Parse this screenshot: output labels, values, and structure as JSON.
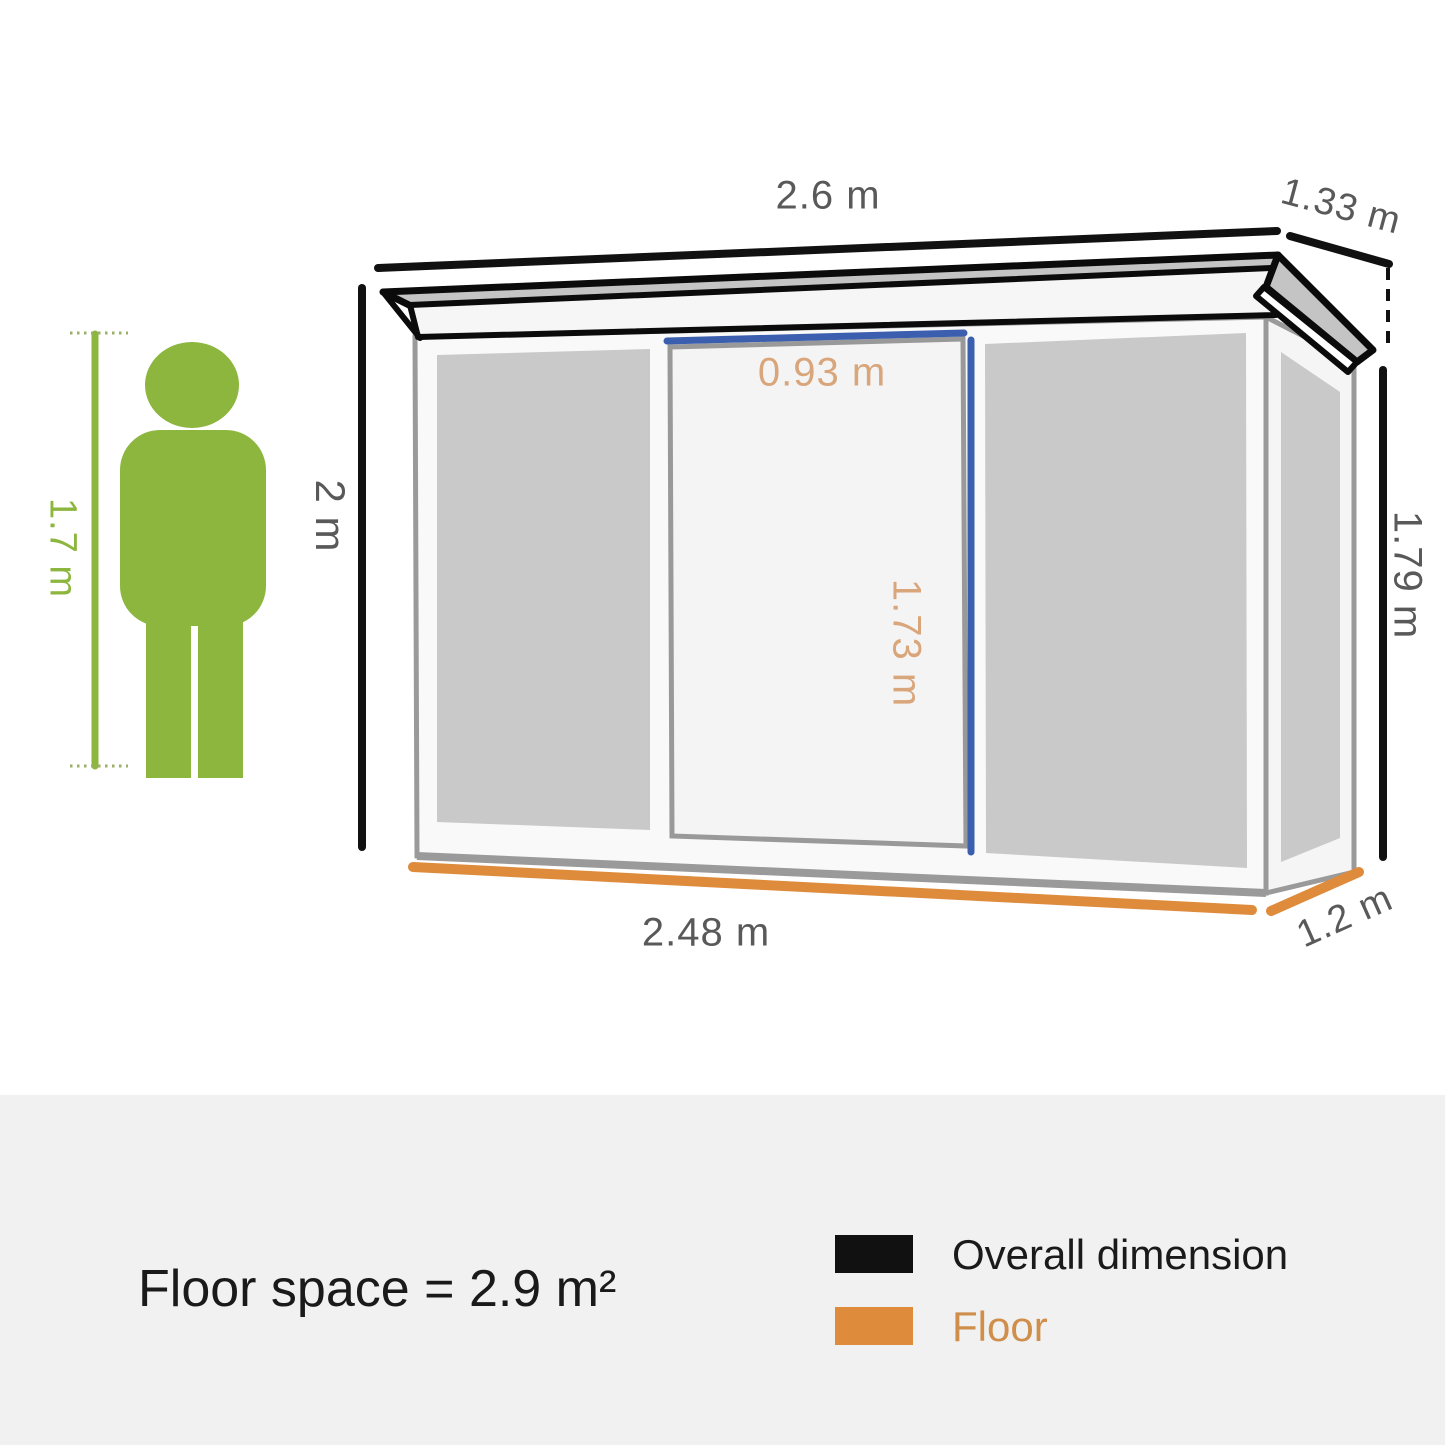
{
  "shed_diagram": {
    "dimensions": {
      "roof_width": "2.6 m",
      "roof_depth": "1.33 m",
      "wall_height_left": "2 m",
      "wall_height_right": "1.79 m",
      "door_width": "0.93 m",
      "door_height": "1.73 m",
      "floor_width": "2.48 m",
      "floor_depth": "1.2 m",
      "person_height": "1.7 m"
    },
    "colors": {
      "overall_dimension_line": "#111111",
      "floor_line": "#de8b3c",
      "door_dimension_line": "#3b5fae",
      "door_dimension_text": "#d9a57b",
      "dimension_text": "#595959",
      "person_green": "#8cb63e",
      "panel_gray": "#c9c9c9",
      "footer_background": "#f1f1f1"
    }
  },
  "footer": {
    "floor_space": "Floor space = 2.9 m²",
    "legend": [
      {
        "label": "Overall dimension",
        "color": "#111111"
      },
      {
        "label": "Floor",
        "color": "#de8b3c"
      }
    ]
  }
}
